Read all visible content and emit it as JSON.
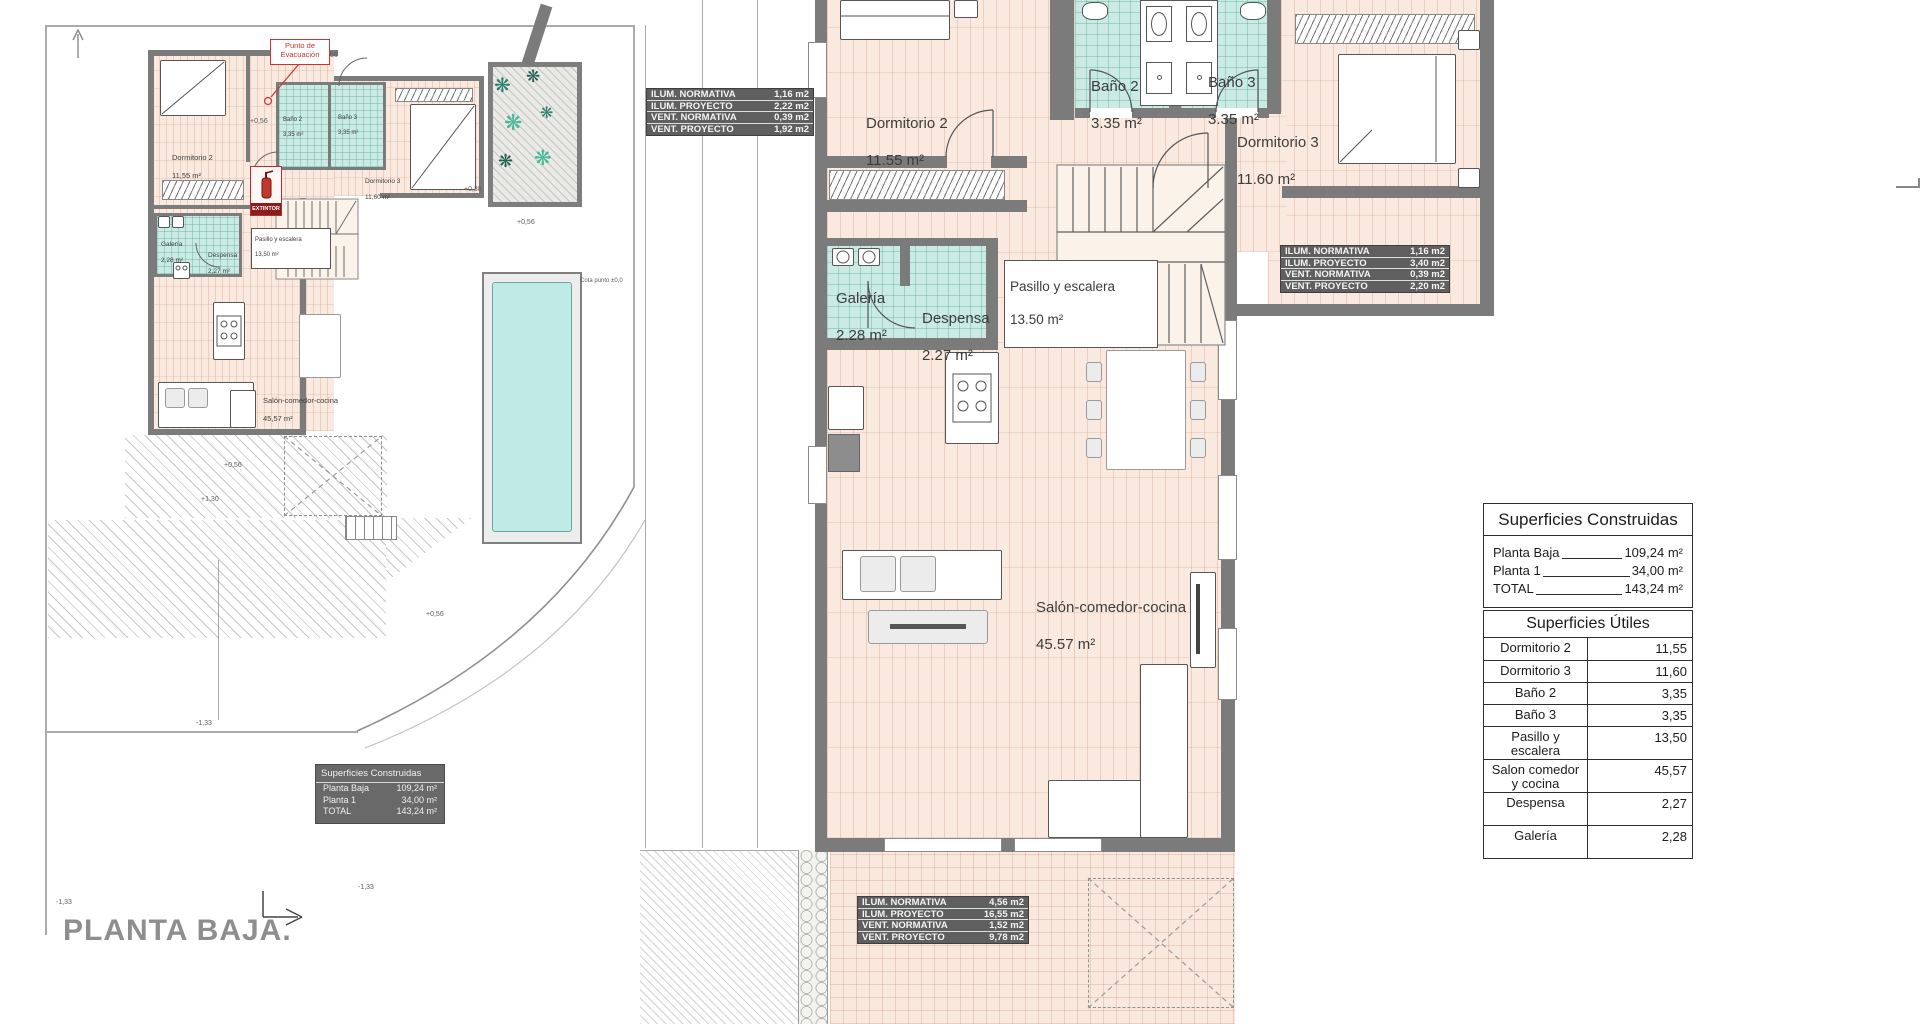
{
  "document": {
    "title": "PLANTA BAJA."
  },
  "colors": {
    "floor": "#f9e9de",
    "bath_floor": "#c9ebe3",
    "wall": "#7b7b7b",
    "pool": "#bfe9e5",
    "accent_red": "#c0392b",
    "table_dark": "#5f5f5f"
  },
  "left_plan": {
    "rooms": [
      {
        "name": "Dormitorio 2",
        "area": "11,55 m²"
      },
      {
        "name": "Baño 2",
        "area": "3,35 m²"
      },
      {
        "name": "Baño 3",
        "area": "3,35 m²"
      },
      {
        "name": "Dormitorio 3",
        "area": "11,60 m²"
      },
      {
        "name": "Galería",
        "area": "2,28 m²"
      },
      {
        "name": "Despensa",
        "area": "2,27 m²"
      },
      {
        "name": "Pasillo y escalera",
        "area": "13,50 m²"
      },
      {
        "name": "Salón-comedor-cocina",
        "area": "45,57 m²"
      }
    ],
    "evacuation_label": "Punto de\nEvacuación",
    "extinguisher_label": "EXTINTOR",
    "cota_label": "Cota punto ±0,0",
    "levels": [
      "+0,56",
      "+0,56",
      "+0,38",
      "+0,56",
      "+1,30",
      "+0,56",
      "+0,56",
      "-1,33",
      "-1,33",
      "-1,33"
    ],
    "construidas": {
      "title": "Superficies Construidas",
      "rows": [
        [
          "Planta Baja",
          "109,24 m²"
        ],
        [
          "Planta 1",
          "34,00 m²"
        ],
        [
          "TOTAL",
          "143,24 m²"
        ]
      ]
    }
  },
  "right_plan": {
    "rooms": [
      {
        "name": "Dormitorio 2",
        "area": "11.55 m²"
      },
      {
        "name": "Baño 2",
        "area": "3.35 m²"
      },
      {
        "name": "Baño 3",
        "area": "3.35 m²"
      },
      {
        "name": "Dormitorio 3",
        "area": "11.60 m²"
      },
      {
        "name": "Galería",
        "area": "2.28 m²"
      },
      {
        "name": "Despensa",
        "area": "2.27 m²"
      },
      {
        "name": "Pasillo y escalera",
        "area": "13.50 m²"
      },
      {
        "name": "Salón-comedor-cocina",
        "area": "45.57 m²"
      }
    ]
  },
  "ilum_tables": {
    "top_left": {
      "rows": [
        [
          "ILUM. NORMATIVA",
          "1,16 m2"
        ],
        [
          "ILUM. PROYECTO",
          "2,22 m2"
        ],
        [
          "VENT. NORMATIVA",
          "0,39 m2"
        ],
        [
          "VENT. PROYECTO",
          "1,92 m2"
        ]
      ]
    },
    "right": {
      "rows": [
        [
          "ILUM. NORMATIVA",
          "1,16 m2"
        ],
        [
          "ILUM. PROYECTO",
          "3,40 m2"
        ],
        [
          "VENT. NORMATIVA",
          "0,39 m2"
        ],
        [
          "VENT. PROYECTO",
          "2,20 m2"
        ]
      ]
    },
    "bottom": {
      "rows": [
        [
          "ILUM. NORMATIVA",
          "4,56 m2"
        ],
        [
          "ILUM. PROYECTO",
          "16,55 m2"
        ],
        [
          "VENT. NORMATIVA",
          "1,52 m2"
        ],
        [
          "VENT. PROYECTO",
          "9,78 m2"
        ]
      ]
    }
  },
  "summary_panels": {
    "construidas": {
      "title": "Superficies Construidas",
      "rows": [
        [
          "Planta Baja",
          "109,24 m²"
        ],
        [
          "Planta 1",
          "34,00 m²"
        ],
        [
          "TOTAL",
          "143,24 m²"
        ]
      ]
    },
    "utiles": {
      "title": "Superficies Útiles",
      "rows": [
        [
          "Dormitorio 2",
          "11,55"
        ],
        [
          "Dormitorio 3",
          "11,60"
        ],
        [
          "Baño 2",
          "3,35"
        ],
        [
          "Baño 3",
          "3,35"
        ],
        [
          "Pasillo y\nescalera",
          "13,50"
        ],
        [
          "Salon comedor\ny cocina",
          "45,57"
        ],
        [
          "Despensa",
          "2,27"
        ],
        [
          "Galería",
          "2,28"
        ]
      ]
    }
  }
}
